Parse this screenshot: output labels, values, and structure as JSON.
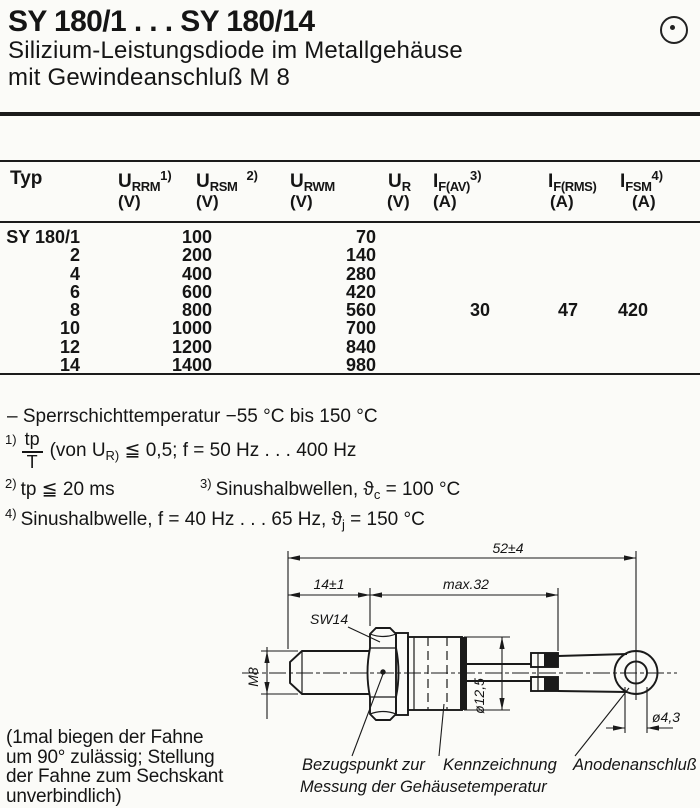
{
  "header": {
    "title": "SY 180/1 . . . SY 180/14",
    "subtitle1": "Silizium-Leistungsdiode im Metallgehäuse",
    "subtitle2": "mit Gewindeanschluß M 8",
    "corner_icon": "circled-dot"
  },
  "table": {
    "col_typ": "Typ",
    "c1": {
      "base": "U",
      "sub": "RRM",
      "sup": "1)",
      "unit": "(V)"
    },
    "c2": {
      "base": "U",
      "sub": "RSM",
      "sup": "2)",
      "unit": "(V)"
    },
    "c3": {
      "base": "U",
      "sub": "RWM",
      "sup": "",
      "unit": "(V)"
    },
    "c4": {
      "base": "U",
      "sub": "R",
      "sup": "",
      "unit": "(V)"
    },
    "c5": {
      "base": "I",
      "sub": "F(AV)",
      "sup": "3)",
      "unit": "(A)"
    },
    "c6": {
      "base": "I",
      "sub": "F(RMS)",
      "sup": "",
      "unit": "(A)"
    },
    "c7": {
      "base": "I",
      "sub": "FSM",
      "sup": "4)",
      "unit": "(A)"
    },
    "rows": [
      {
        "typ": "SY 180/1",
        "urrm_ursm": "100",
        "urwm": "70"
      },
      {
        "typ": "2",
        "urrm_ursm": "200",
        "urwm": "140"
      },
      {
        "typ": "4",
        "urrm_ursm": "400",
        "urwm": "280"
      },
      {
        "typ": "6",
        "urrm_ursm": "600",
        "urwm": "420"
      },
      {
        "typ": "8",
        "urrm_ursm": "800",
        "urwm": "560"
      },
      {
        "typ": "10",
        "urrm_ursm": "1000",
        "urwm": "700"
      },
      {
        "typ": "12",
        "urrm_ursm": "1200",
        "urwm": "840"
      },
      {
        "typ": "14",
        "urrm_ursm": "1400",
        "urwm": "980"
      }
    ],
    "shared": {
      "if_av": "30",
      "if_rms": "47",
      "ifsm": "420"
    }
  },
  "notes": {
    "temp_range": "– Sperrschichttemperatur  −55 °C bis 150 °C",
    "n1": {
      "sup": "1)",
      "num": "tp",
      "den": "T",
      "pre": "(von U",
      "sub": "R)",
      "post": " ≦ 0,5;  f = 50 Hz . . . 400 Hz"
    },
    "n2": {
      "sup": "2)",
      "text": "tp ≦ 20 ms"
    },
    "n3": {
      "sup": "3)",
      "pre": "Sinushalbwellen,  ϑ",
      "sub": "c",
      "post": " = 100 °C"
    },
    "n4": {
      "sup": "4)",
      "pre": "Sinushalbwelle, f = 40 Hz . . . 65 Hz,  ϑ",
      "sub": "j",
      "post": " = 150 °C"
    }
  },
  "drawing": {
    "dim_total": "52±4",
    "dim_stud": "14±1",
    "dim_body": "max.32",
    "wrench": "SW14",
    "thread": "M8",
    "body_dia": "ø12,5",
    "hole_dia": "ø4,3",
    "label_ref1": "Bezugspunkt zur",
    "label_ref2": "Messung der Gehäusetemperatur",
    "label_marking": "Kennzeichnung",
    "label_anode": "Anodenanschluß"
  },
  "side_note": {
    "l1": "(1mal biegen der Fahne",
    "l2": "um 90° zulässig; Stellung",
    "l3": "der Fahne zum Sechskant",
    "l4": "unverbindlich)"
  }
}
